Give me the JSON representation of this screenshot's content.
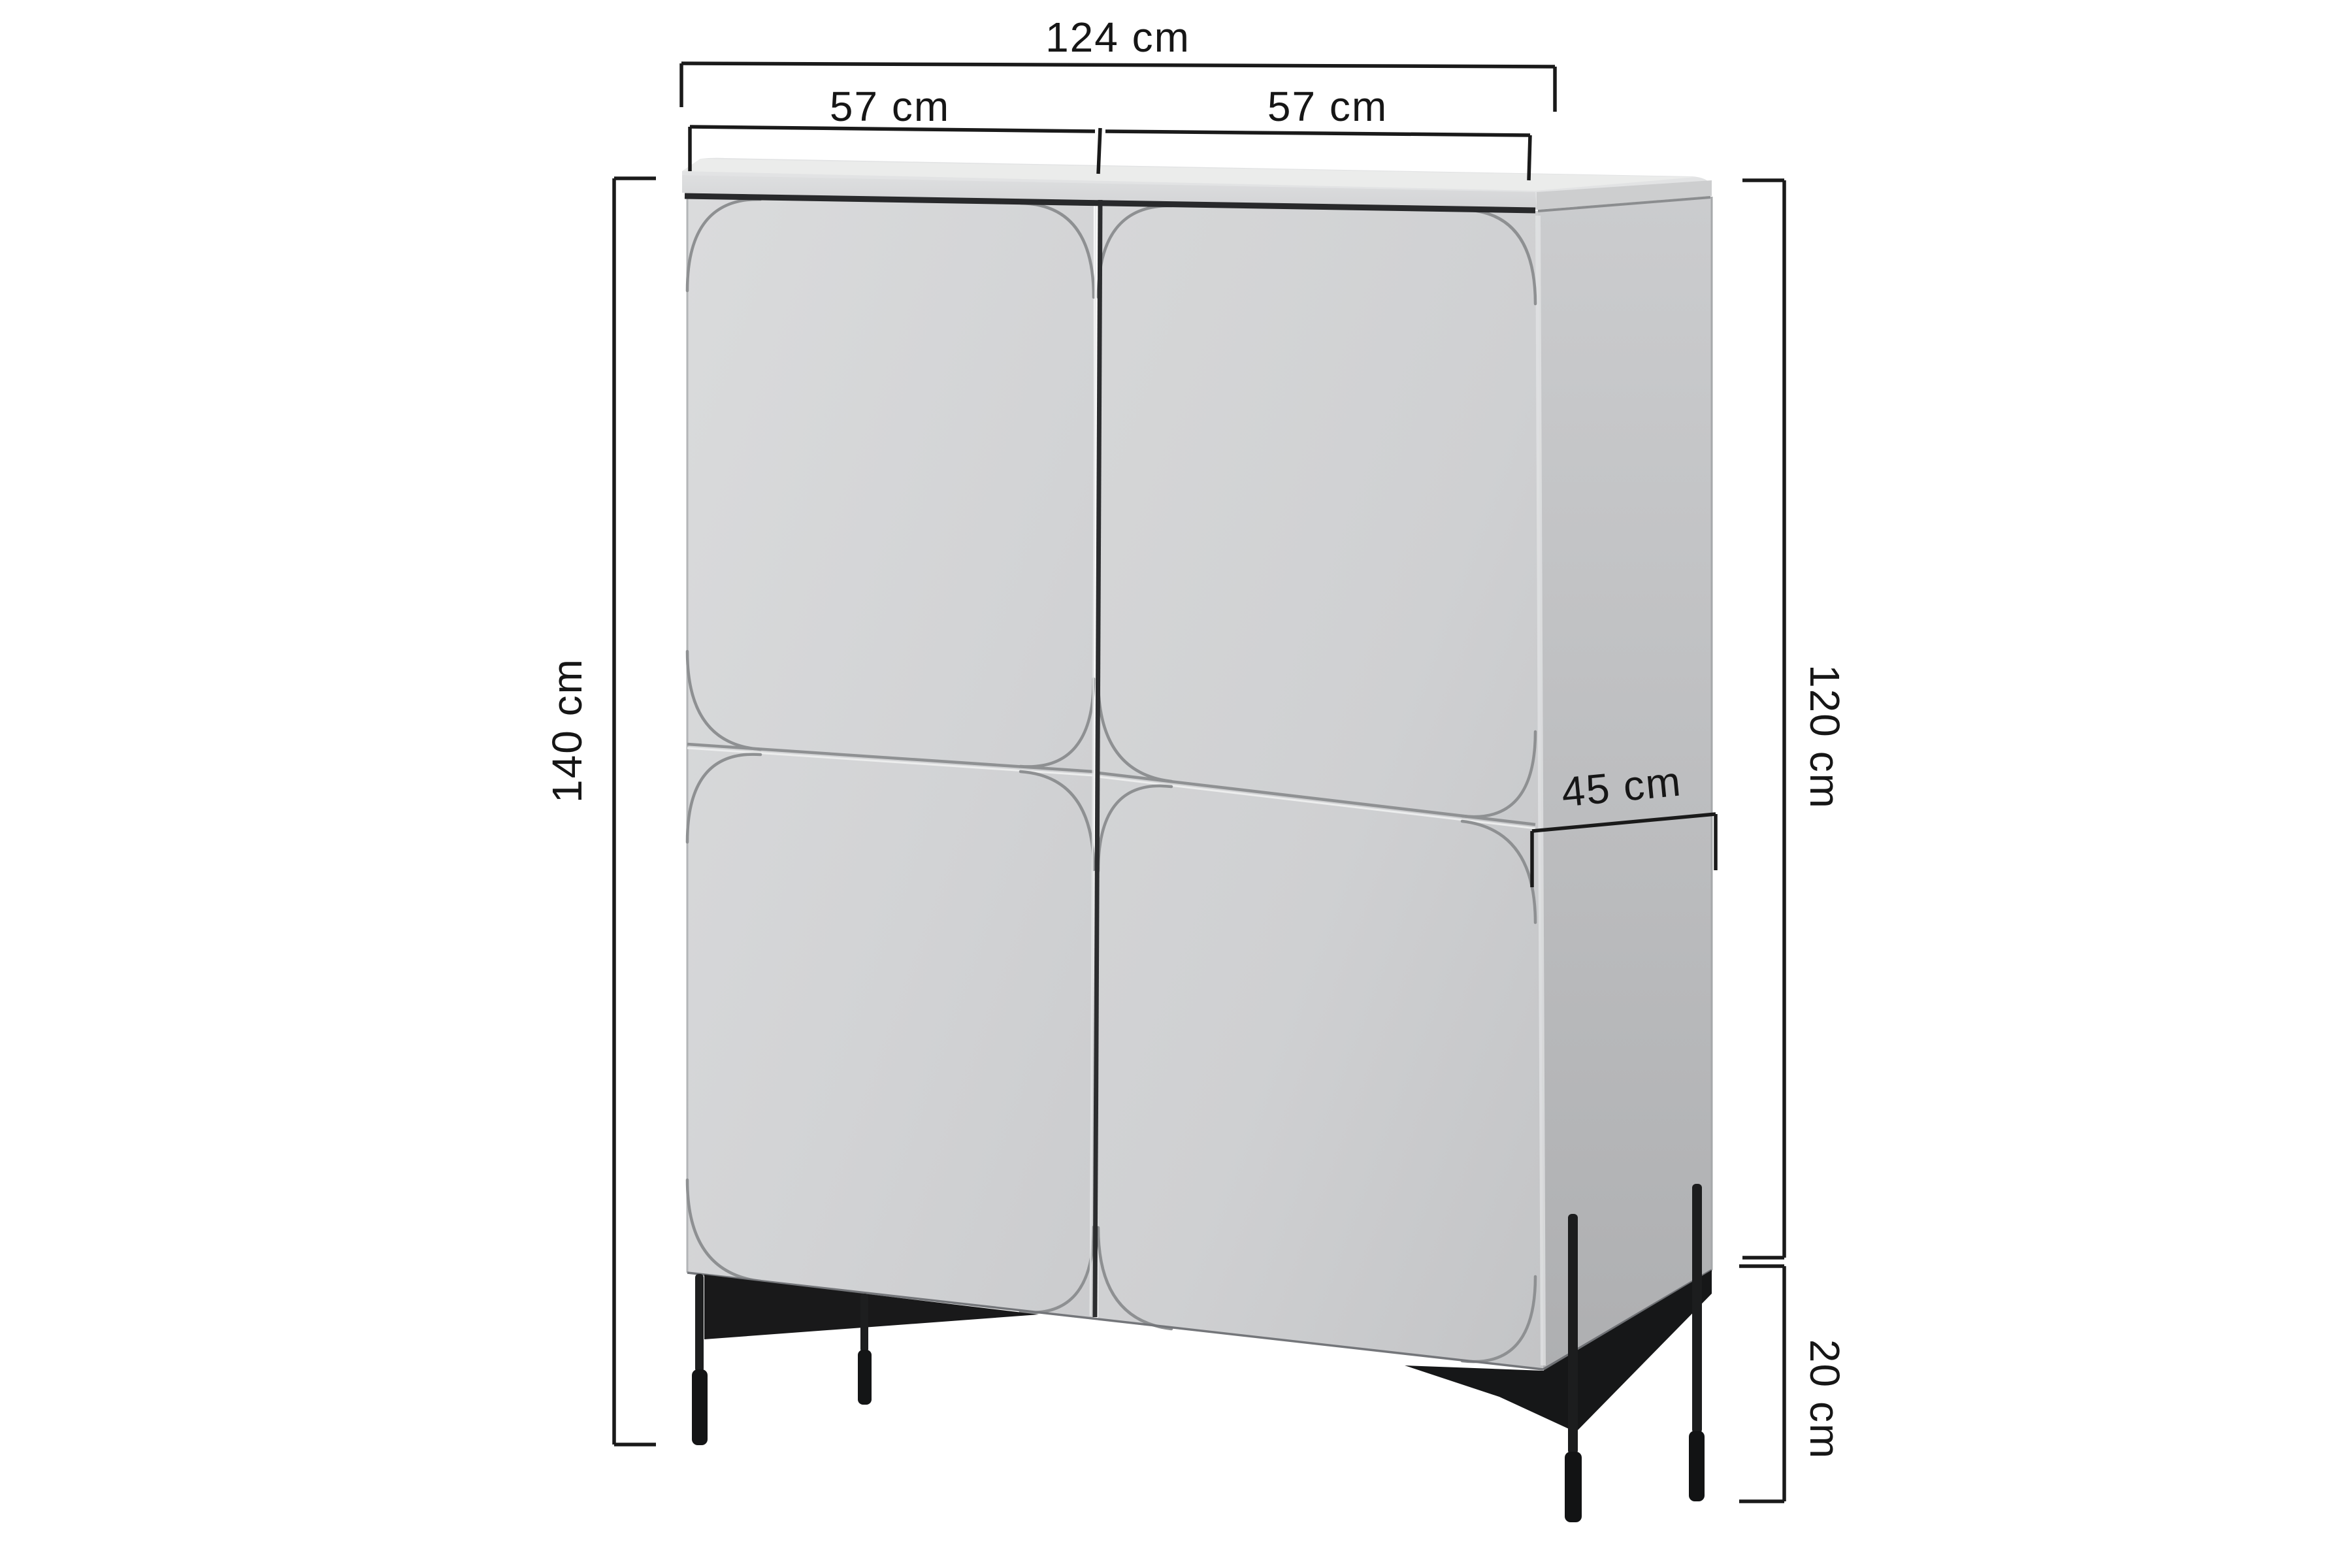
{
  "diagram": {
    "subject": "four-door cabinet on tall metal legs",
    "unit": "cm",
    "dimensions": {
      "total_width": {
        "value": 124,
        "unit": "cm",
        "label": "124 cm"
      },
      "left_door_width": {
        "value": 57,
        "unit": "cm",
        "label": "57 cm"
      },
      "right_door_width": {
        "value": 57,
        "unit": "cm",
        "label": "57 cm"
      },
      "total_height": {
        "value": 140,
        "unit": "cm",
        "label": "140 cm"
      },
      "body_height": {
        "value": 120,
        "unit": "cm",
        "label": "120 cm"
      },
      "depth": {
        "value": 45,
        "unit": "cm",
        "label": "45 cm"
      },
      "leg_height": {
        "value": 20,
        "unit": "cm",
        "label": "20 cm"
      }
    },
    "colors": {
      "background": "#ffffff",
      "cabinet_front": "#d3d4d6",
      "cabinet_side": "#bcbec0",
      "cabinet_top": "#e8e9ea",
      "groove": "#8f9193",
      "door_gap": "#2c2d2f",
      "underside_shadow": "#161718",
      "legs": "#1b1c1e",
      "dimension_lines": "#1a1a1a",
      "dimension_text": "#161616"
    }
  }
}
